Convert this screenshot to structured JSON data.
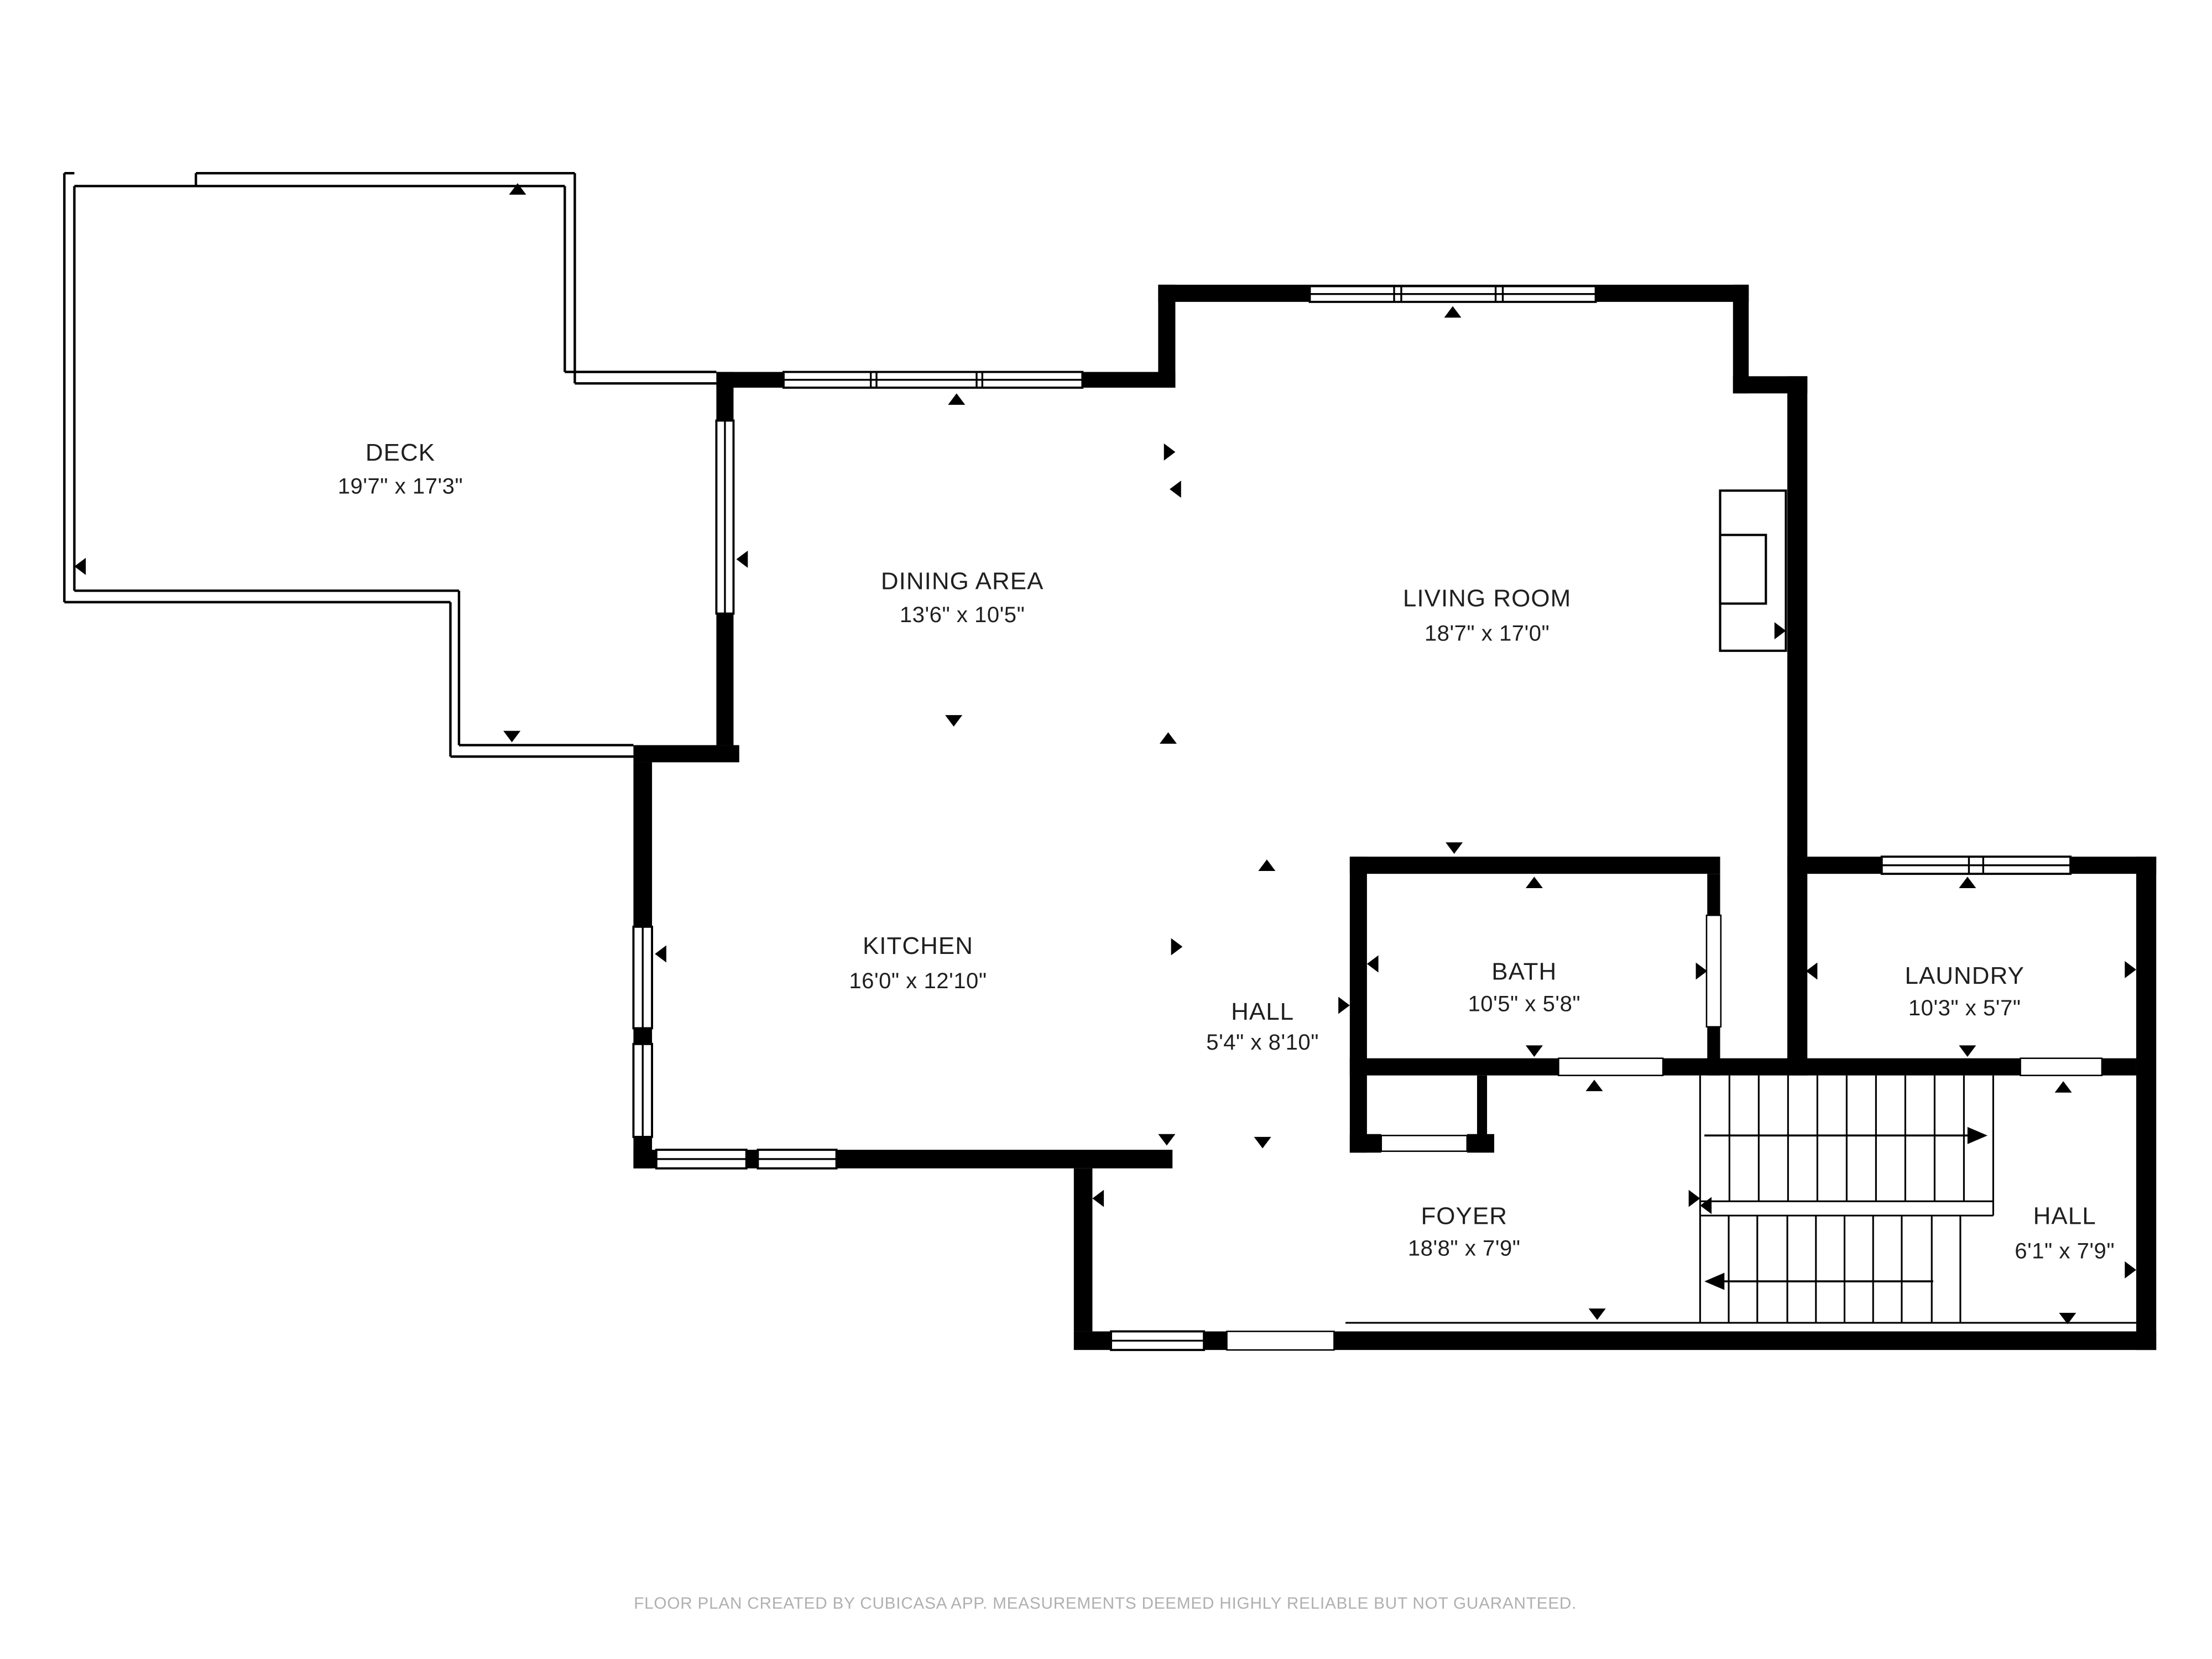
{
  "floor_plan": {
    "rooms": [
      {
        "id": "deck",
        "name": "DECK",
        "dimensions": "19'7\" x 17'3\""
      },
      {
        "id": "dining",
        "name": "DINING AREA",
        "dimensions": "13'6\" x 10'5\""
      },
      {
        "id": "living",
        "name": "LIVING ROOM",
        "dimensions": "18'7\" x 17'0\""
      },
      {
        "id": "kitchen",
        "name": "KITCHEN",
        "dimensions": "16'0\" x 12'10\""
      },
      {
        "id": "hall-upper",
        "name": "HALL",
        "dimensions": "5'4\" x 8'10\""
      },
      {
        "id": "bath",
        "name": "BATH",
        "dimensions": "10'5\" x 5'8\""
      },
      {
        "id": "laundry",
        "name": "LAUNDRY",
        "dimensions": "10'3\" x 5'7\""
      },
      {
        "id": "foyer",
        "name": "FOYER",
        "dimensions": "18'8\" x 7'9\""
      },
      {
        "id": "hall-lower",
        "name": "HALL",
        "dimensions": "6'1\" x 7'9\""
      }
    ],
    "footer_disclaimer": "FLOOR PLAN CREATED BY CUBICASA APP. MEASUREMENTS DEEMED HIGHLY RELIABLE BUT NOT GUARANTEED.",
    "colors": {
      "wall": "#000000",
      "background": "#ffffff",
      "label_text": "#1f1f1f",
      "footer_text": "#b0b0b0"
    }
  }
}
